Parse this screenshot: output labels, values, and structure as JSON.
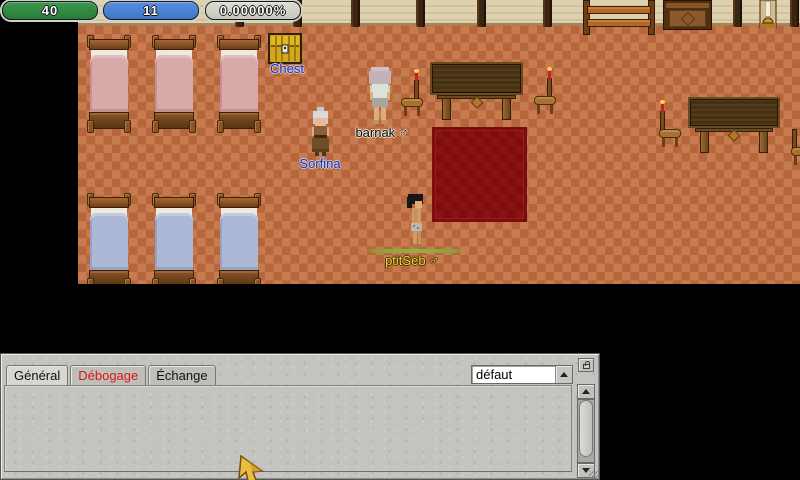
{
  "hud": {
    "hp": {
      "value": "40",
      "color": "#2f8a40"
    },
    "mp": {
      "value": "11",
      "color": "#4b84d8"
    },
    "exp": {
      "value": "0.00000%",
      "color": "#d2d2c6"
    }
  },
  "map": {
    "entities": {
      "chest": {
        "label": "Chest"
      },
      "sorfina": {
        "label": "Sorfina"
      },
      "barnak": {
        "label": "barnak ♂"
      },
      "ptitseb": {
        "label": "ptitSeb ♂"
      }
    }
  },
  "chat": {
    "tabs": [
      {
        "label": "Général",
        "state": "active"
      },
      {
        "label": "Débogage",
        "state": "alert"
      },
      {
        "label": "Échange",
        "state": "normal"
      }
    ],
    "channel_dropdown": {
      "value": "défaut"
    }
  },
  "colors": {
    "npc_label": "#2b2b9e",
    "other_player_label": "#0a0a0a",
    "self_player_label": "#e9d53e",
    "alert_tab_text": "#e01414",
    "hp_bar": "#2f8a40",
    "mp_bar": "#4b84d8"
  }
}
